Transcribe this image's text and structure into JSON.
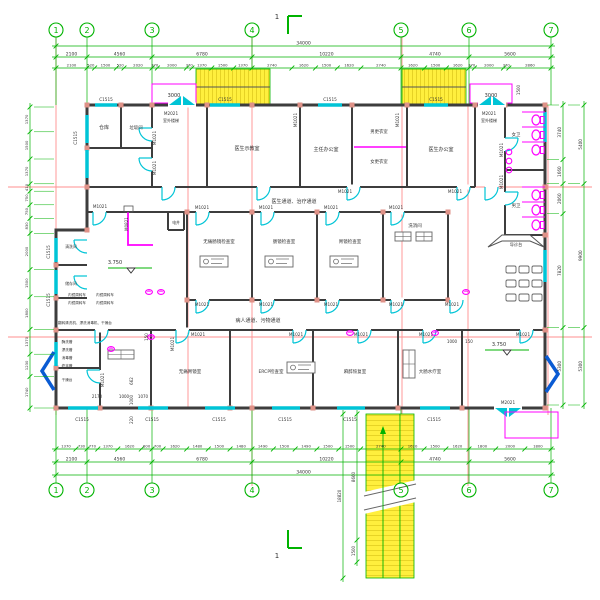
{
  "palette": {
    "green": "#00b300",
    "red": "#ff8f8f",
    "cyan": "#00c4d6",
    "magenta": "#ff00ff",
    "yellow": "#ffef3d",
    "yellow_stripe": "#bfa800",
    "wall": "#3d3d3d",
    "column": "#df9288",
    "dim_text": "#333333",
    "blue": "#0a5bd3"
  },
  "bubbles": {
    "y_top": 30,
    "y_bottom": 490,
    "top": [
      {
        "n": "1",
        "x": 56
      },
      {
        "n": "2",
        "x": 87
      },
      {
        "n": "3",
        "x": 152
      },
      {
        "n": "4",
        "x": 252
      },
      {
        "n": "5",
        "x": 401
      },
      {
        "n": "6",
        "x": 469
      },
      {
        "n": "7",
        "x": 551
      }
    ],
    "bottom": [
      {
        "n": "1",
        "x": 56
      },
      {
        "n": "2",
        "x": 87
      },
      {
        "n": "3",
        "x": 152
      },
      {
        "n": "4",
        "x": 252
      },
      {
        "n": "5",
        "x": 401
      },
      {
        "n": "6",
        "x": 469
      },
      {
        "n": "7",
        "x": 551
      }
    ]
  },
  "chains": [
    {
      "name": "top-total",
      "o": "h",
      "y": 46,
      "pts": [
        56,
        551
      ],
      "lbl": [
        "34000"
      ],
      "fs": 4.6
    },
    {
      "name": "top-bays",
      "o": "h",
      "y": 57,
      "pts": [
        56,
        87,
        152,
        252,
        401,
        469,
        551
      ],
      "lbl": [
        "2100",
        "4560",
        "6780",
        "10220",
        "4740",
        "5600"
      ],
      "fs": 4.5
    },
    {
      "name": "top-detail",
      "o": "h",
      "y": 68,
      "pts": [
        56,
        87,
        94.6,
        116.4,
        124,
        152,
        157.4,
        186.5,
        191.9,
        211.8,
        233.7,
        252,
        291.9,
        315.5,
        337.3,
        360.9,
        401,
        424.6,
        446.4,
        469,
        474.4,
        503.5,
        508.9,
        551
      ],
      "lbl": [
        "2100",
        "520",
        "1500",
        "520",
        "2020",
        "370",
        "2000",
        "370",
        "1370",
        "1500",
        "1370",
        "2740",
        "1620",
        "1500",
        "1620",
        "2740",
        "1620",
        "1500",
        "1620",
        "370",
        "2000",
        "370",
        "2860"
      ],
      "fs": 3.8
    },
    {
      "name": "bottom-detail",
      "o": "h",
      "y": 449,
      "pts": [
        56,
        75.9,
        87,
        97.8,
        117.8,
        141.3,
        152,
        163.1,
        186.7,
        208.3,
        230.1,
        252,
        273.4,
        295.2,
        316.9,
        338.8,
        360.6,
        401,
        424.1,
        445.9,
        469,
        495.7,
        524.8,
        551
      ],
      "lbl": [
        "1370",
        "730",
        "770",
        "1370",
        "1620",
        "800",
        "700",
        "1620",
        "1480",
        "1500",
        "1480",
        "1490",
        "1500",
        "1490",
        "1500",
        "1500",
        "2740",
        "1620",
        "1500",
        "1620",
        "1800",
        "2000",
        "1800"
      ],
      "fs": 3.8
    },
    {
      "name": "bottom-bays",
      "o": "h",
      "y": 462,
      "pts": [
        56,
        87,
        152,
        252,
        401,
        469,
        551
      ],
      "lbl": [
        "2100",
        "4560",
        "6780",
        "10220",
        "4740",
        "5600"
      ],
      "fs": 4.5
    },
    {
      "name": "bottom-total",
      "o": "h",
      "y": 475,
      "pts": [
        56,
        551
      ],
      "lbl": [
        "34000"
      ],
      "fs": 4.6
    },
    {
      "name": "left-detail",
      "o": "v",
      "x": 30,
      "ext": 24,
      "pts": [
        107,
        131.8,
        159,
        183.8,
        191.2,
        204.8,
        218.4,
        233.4,
        269.6,
        296.8,
        329.4,
        354.2,
        376.5,
        408
      ],
      "lbl": [
        "1370",
        "1500",
        "1370",
        "410",
        "750",
        "750",
        "830",
        "2000",
        "1500",
        "1800",
        "1370",
        "1230",
        "1740"
      ],
      "fs": 3.8
    },
    {
      "name": "right-inner",
      "o": "v",
      "x": 563,
      "ext": -16,
      "pts": [
        105,
        159.5,
        183.7,
        213.7,
        327.6,
        405
      ],
      "lbl": [
        "3740",
        "1660",
        "2060",
        "7820",
        "5300"
      ],
      "fs": 4.2
    },
    {
      "name": "right-outer",
      "o": "v",
      "x": 584,
      "ext": -16,
      "pts": [
        105,
        183.7,
        327.6,
        405
      ],
      "lbl": [
        "5400",
        "9900",
        "5300"
      ],
      "fs": 4.2
    },
    {
      "name": "stair-dim",
      "o": "v",
      "x": 357,
      "pts": [
        414,
        540,
        562
      ],
      "lbl": [
        "8660",
        "1500"
      ],
      "fs": 4
    },
    {
      "name": "stair-total",
      "o": "v",
      "x": 343,
      "pts": [
        414,
        578
      ],
      "lbl": [
        "18820"
      ],
      "fs": 4
    }
  ],
  "texts": [
    {
      "n": "canopy-dim",
      "t": "3000",
      "x": 174,
      "y": 97,
      "s": 5
    },
    {
      "n": "canopy-dim",
      "t": "3000",
      "x": 491,
      "y": 97,
      "s": 5
    },
    {
      "n": "dim-label",
      "t": "1500",
      "x": 520,
      "y": 90,
      "s": 4,
      "r": -90
    },
    {
      "n": "room-label",
      "t": "仓库",
      "x": 104,
      "y": 129,
      "s": 5
    },
    {
      "n": "room-label",
      "t": "垃圾间",
      "x": 136,
      "y": 129,
      "s": 4.4
    },
    {
      "n": "room-label",
      "t": "医生示教室",
      "x": 247,
      "y": 150,
      "s": 5
    },
    {
      "n": "room-label",
      "t": "主任办公室",
      "x": 326,
      "y": 151,
      "s": 5
    },
    {
      "n": "room-label",
      "t": "男更衣室",
      "x": 379,
      "y": 133,
      "s": 4.4
    },
    {
      "n": "room-label",
      "t": "女更衣室",
      "x": 379,
      "y": 163,
      "s": 4.4
    },
    {
      "n": "room-label",
      "t": "医生办公室",
      "x": 441,
      "y": 151,
      "s": 5
    },
    {
      "n": "room-label",
      "t": "女卫",
      "x": 516,
      "y": 136,
      "s": 4.4
    },
    {
      "n": "room-label",
      "t": "男卫",
      "x": 516,
      "y": 207,
      "s": 4.4
    },
    {
      "n": "door-tag",
      "t": "M2021",
      "x": 171,
      "y": 115,
      "s": 4.2
    },
    {
      "n": "door-tag",
      "t": "M2021",
      "x": 489,
      "y": 115,
      "s": 4.2
    },
    {
      "n": "door-tag",
      "t": "M2021",
      "x": 508,
      "y": 404,
      "s": 4.2
    },
    {
      "n": "stair-label",
      "t": "室外楼梯",
      "x": 171,
      "y": 122,
      "s": 4
    },
    {
      "n": "stair-label",
      "t": "室外楼梯",
      "x": 489,
      "y": 122,
      "s": 4
    },
    {
      "n": "corridor-label",
      "t": "医生通道、治疗通道",
      "x": 294,
      "y": 203,
      "s": 5
    },
    {
      "n": "corridor-label",
      "t": "病人通道、污物通道",
      "x": 258,
      "y": 322,
      "s": 5
    },
    {
      "n": "room-label",
      "t": "无痛肠镜检查室",
      "x": 219,
      "y": 243,
      "s": 4.5
    },
    {
      "n": "room-label",
      "t": "肠镜检查室",
      "x": 284,
      "y": 243,
      "s": 4.5
    },
    {
      "n": "room-label",
      "t": "胃镜检查室",
      "x": 350,
      "y": 243,
      "s": 4.5
    },
    {
      "n": "room-label",
      "t": "洗消间",
      "x": 415,
      "y": 227,
      "s": 4.5
    },
    {
      "n": "room-label",
      "t": "无痛胃镜室",
      "x": 190,
      "y": 373,
      "s": 4.5
    },
    {
      "n": "room-label",
      "t": "ERCP检查室",
      "x": 271,
      "y": 373,
      "s": 4.5
    },
    {
      "n": "room-label",
      "t": "麻醉恢复室",
      "x": 355,
      "y": 373,
      "s": 4.5
    },
    {
      "n": "room-label",
      "t": "大肠水疗室",
      "x": 430,
      "y": 373,
      "s": 4.5
    },
    {
      "n": "desk-label",
      "t": "导诊台",
      "x": 516,
      "y": 246,
      "s": 4.2
    },
    {
      "n": "level-label",
      "t": "3.750",
      "x": 115,
      "y": 264,
      "s": 5
    },
    {
      "n": "level-label",
      "t": "3.750",
      "x": 499,
      "y": 346,
      "s": 5
    },
    {
      "n": "room-label",
      "t": "电井",
      "x": 176,
      "y": 224,
      "s": 3.8
    },
    {
      "n": "equipment-label",
      "t": "翻转清洗机、漂洗消毒机、干燥台",
      "x": 58,
      "y": 324,
      "s": 3.6,
      "a": "start"
    },
    {
      "n": "equipment-label",
      "t": "内镜周转车",
      "x": 77,
      "y": 296,
      "s": 3.6
    },
    {
      "n": "equipment-label",
      "t": "内镜周转车",
      "x": 105,
      "y": 296,
      "s": 3.6
    },
    {
      "n": "equipment-label",
      "t": "内镜周转车",
      "x": 77,
      "y": 304,
      "s": 3.6
    },
    {
      "n": "equipment-label",
      "t": "内镜周转车",
      "x": 105,
      "y": 304,
      "s": 3.6
    },
    {
      "n": "equipment-label",
      "t": "酶洗槽",
      "x": 67,
      "y": 343,
      "s": 3.6
    },
    {
      "n": "equipment-label",
      "t": "漂洗槽",
      "x": 67,
      "y": 351,
      "s": 3.6
    },
    {
      "n": "equipment-label",
      "t": "消毒槽",
      "x": 67,
      "y": 359,
      "s": 3.6
    },
    {
      "n": "equipment-label",
      "t": "终末槽",
      "x": 67,
      "y": 367,
      "s": 3.6
    },
    {
      "n": "equipment-label",
      "t": "干燥台",
      "x": 67,
      "y": 381,
      "s": 3.6
    },
    {
      "n": "room-label",
      "t": "清洗间",
      "x": 71,
      "y": 248,
      "s": 3.8
    },
    {
      "n": "room-label",
      "t": "储存间",
      "x": 71,
      "y": 285,
      "s": 3.8
    },
    {
      "n": "section-number",
      "t": "1",
      "x": 277,
      "y": 19,
      "s": 7
    },
    {
      "n": "section-number",
      "t": "1",
      "x": 277,
      "y": 558,
      "s": 7
    },
    {
      "n": "dim-label",
      "t": "150",
      "x": 148,
      "y": 337,
      "s": 4,
      "r": -90
    },
    {
      "n": "dim-label",
      "t": "662",
      "x": 133,
      "y": 381,
      "s": 4,
      "r": -90
    },
    {
      "n": "dim-label",
      "t": "1000",
      "x": 133,
      "y": 400,
      "s": 4,
      "r": -90
    },
    {
      "n": "dim-label",
      "t": "2170",
      "x": 97,
      "y": 398,
      "s": 4
    },
    {
      "n": "dim-label",
      "t": "1000",
      "x": 124,
      "y": 398,
      "s": 4
    },
    {
      "n": "dim-label",
      "t": "1070",
      "x": 143,
      "y": 398,
      "s": 4
    },
    {
      "n": "dim-label",
      "t": "220",
      "x": 133,
      "y": 420,
      "s": 4,
      "r": -90
    },
    {
      "n": "dim-label",
      "t": "1000",
      "x": 452,
      "y": 343,
      "s": 4
    },
    {
      "n": "dim-label",
      "t": "150",
      "x": 469,
      "y": 343,
      "s": 4
    },
    {
      "n": "door-tag",
      "t": "M1021",
      "x": 345,
      "y": 193,
      "s": 4.2
    },
    {
      "n": "door-tag",
      "t": "M1021",
      "x": 455,
      "y": 193,
      "s": 4.2
    },
    {
      "n": "door-tag",
      "t": "M1021",
      "x": 100,
      "y": 208,
      "s": 4.2
    },
    {
      "n": "door-tag",
      "t": "M1021",
      "x": 202,
      "y": 209,
      "s": 4.2
    },
    {
      "n": "door-tag",
      "t": "M1021",
      "x": 266,
      "y": 209,
      "s": 4.2
    },
    {
      "n": "door-tag",
      "t": "M1021",
      "x": 331,
      "y": 209,
      "s": 4.2
    },
    {
      "n": "door-tag",
      "t": "M1021",
      "x": 396,
      "y": 209,
      "s": 4.2
    },
    {
      "n": "door-tag",
      "t": "M1021",
      "x": 202,
      "y": 306,
      "s": 4.2
    },
    {
      "n": "door-tag",
      "t": "M1021",
      "x": 266,
      "y": 306,
      "s": 4.2
    },
    {
      "n": "door-tag",
      "t": "M1021",
      "x": 331,
      "y": 306,
      "s": 4.2
    },
    {
      "n": "door-tag",
      "t": "M1021",
      "x": 396,
      "y": 306,
      "s": 4.2
    },
    {
      "n": "door-tag",
      "t": "M1021",
      "x": 452,
      "y": 306,
      "s": 4.2
    },
    {
      "n": "door-tag",
      "t": "M1021",
      "x": 198,
      "y": 336,
      "s": 4.2
    },
    {
      "n": "door-tag",
      "t": "M1021",
      "x": 296,
      "y": 336,
      "s": 4.2
    },
    {
      "n": "door-tag",
      "t": "M1021",
      "x": 361,
      "y": 336,
      "s": 4.2
    },
    {
      "n": "door-tag",
      "t": "M1021",
      "x": 426,
      "y": 336,
      "s": 4.2
    },
    {
      "n": "door-tag",
      "t": "M1021",
      "x": 523,
      "y": 336,
      "s": 4.2
    },
    {
      "n": "door-tag",
      "t": "M1021",
      "x": 156,
      "y": 138,
      "s": 4.2,
      "r": -90
    },
    {
      "n": "door-tag",
      "t": "M1021",
      "x": 156,
      "y": 168,
      "s": 4.2,
      "r": -90
    },
    {
      "n": "door-tag",
      "t": "M1021",
      "x": 297,
      "y": 120,
      "s": 4.2,
      "r": -90
    },
    {
      "n": "door-tag",
      "t": "M1021",
      "x": 399,
      "y": 120,
      "s": 4.2,
      "r": -90
    },
    {
      "n": "door-tag",
      "t": "M1021",
      "x": 503,
      "y": 150,
      "s": 4.2,
      "r": -90
    },
    {
      "n": "door-tag",
      "t": "M1021",
      "x": 503,
      "y": 182,
      "s": 4.2,
      "r": -90
    },
    {
      "n": "door-tag",
      "t": "M1021",
      "x": 174,
      "y": 344,
      "s": 4.2,
      "r": -90
    },
    {
      "n": "door-tag",
      "t": "M1021",
      "x": 104,
      "y": 380,
      "s": 4.2,
      "r": -90
    },
    {
      "n": "door-tag",
      "t": "M0821",
      "x": 128,
      "y": 224,
      "s": 4,
      "r": -90
    },
    {
      "n": "window-tag",
      "t": "C1515",
      "x": 106,
      "y": 101,
      "s": 4.2
    },
    {
      "n": "window-tag",
      "t": "C1515",
      "x": 225,
      "y": 101,
      "s": 4.2
    },
    {
      "n": "window-tag",
      "t": "C1515",
      "x": 330,
      "y": 101,
      "s": 4.2
    },
    {
      "n": "window-tag",
      "t": "C1515",
      "x": 436,
      "y": 101,
      "s": 4.2
    },
    {
      "n": "window-tag",
      "t": "C1515",
      "x": 82,
      "y": 421,
      "s": 4.2
    },
    {
      "n": "window-tag",
      "t": "C1515",
      "x": 152,
      "y": 421,
      "s": 4.2
    },
    {
      "n": "window-tag",
      "t": "C1515",
      "x": 219,
      "y": 421,
      "s": 4.2
    },
    {
      "n": "window-tag",
      "t": "C1515",
      "x": 285,
      "y": 421,
      "s": 4.2
    },
    {
      "n": "window-tag",
      "t": "C1515",
      "x": 350,
      "y": 421,
      "s": 4.2
    },
    {
      "n": "window-tag",
      "t": "C1515",
      "x": 434,
      "y": 421,
      "s": 4.2
    },
    {
      "n": "window-tag",
      "t": "C1515",
      "x": 77,
      "y": 138,
      "s": 4.2,
      "r": -90
    },
    {
      "n": "window-tag",
      "t": "C1515",
      "x": 50,
      "y": 252,
      "s": 4.2,
      "r": -90
    },
    {
      "n": "window-tag",
      "t": "C1515",
      "x": 50,
      "y": 300,
      "s": 4.2,
      "r": -90
    }
  ]
}
